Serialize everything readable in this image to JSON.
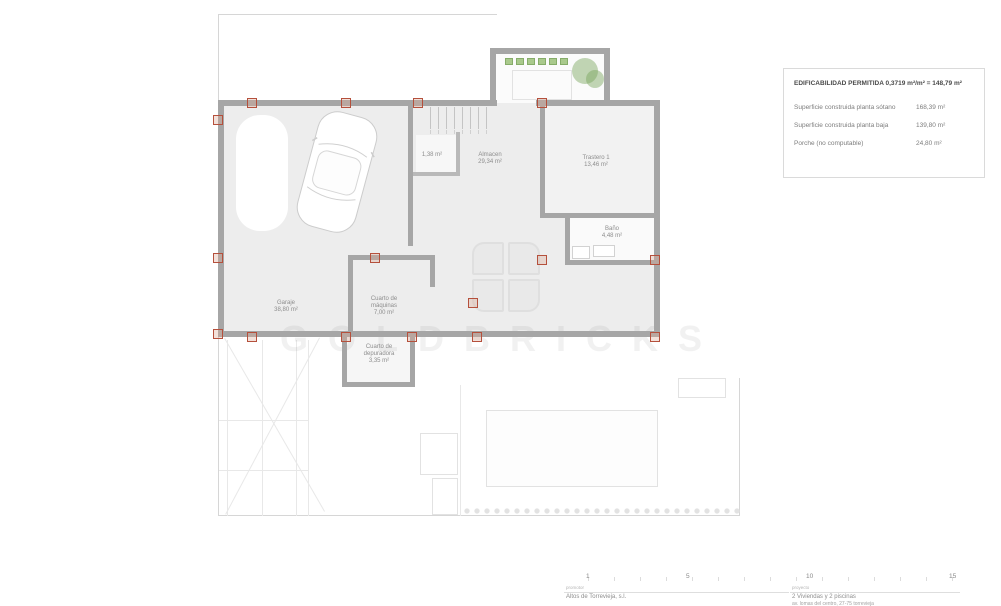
{
  "legend": {
    "title": "EDIFICABILIDAD PERMITIDA 0,3719 m²/m² = 148,79 m²",
    "rows": [
      {
        "label": "Superficie construida planta sótano",
        "value": "168,39 m²"
      },
      {
        "label": "Superficie construida planta baja",
        "value": "139,80 m²"
      },
      {
        "label": "Porche (no computable)",
        "value": "24,80 m²"
      }
    ]
  },
  "rooms": [
    {
      "name": "Garaje",
      "area": "38,80 m²"
    },
    {
      "name": "Cuarto de máquinas",
      "area": "7,00 m²"
    },
    {
      "name": "Cuarto de depuradora",
      "area": "3,35 m²"
    },
    {
      "name": "Almacen",
      "area": "29,34 m²"
    },
    {
      "name": "",
      "area": "1,38 m²"
    },
    {
      "name": "Trastero 1",
      "area": "13,46 m²"
    },
    {
      "name": "Baño",
      "area": "4,48 m²"
    }
  ],
  "watermark": {
    "text": "GOLDBRICKS"
  },
  "scalebar": {
    "ticks": [
      "1",
      "5",
      "10",
      "15"
    ]
  },
  "titleblock": {
    "promoter_label": "promotor",
    "promoter": "Altos de Torrevieja, s.l.",
    "project_label": "proyecto",
    "project": "2 Viviendas y 2 piscinas",
    "project_line2": "av. lomas del centro, 27-75 torrevieja"
  }
}
